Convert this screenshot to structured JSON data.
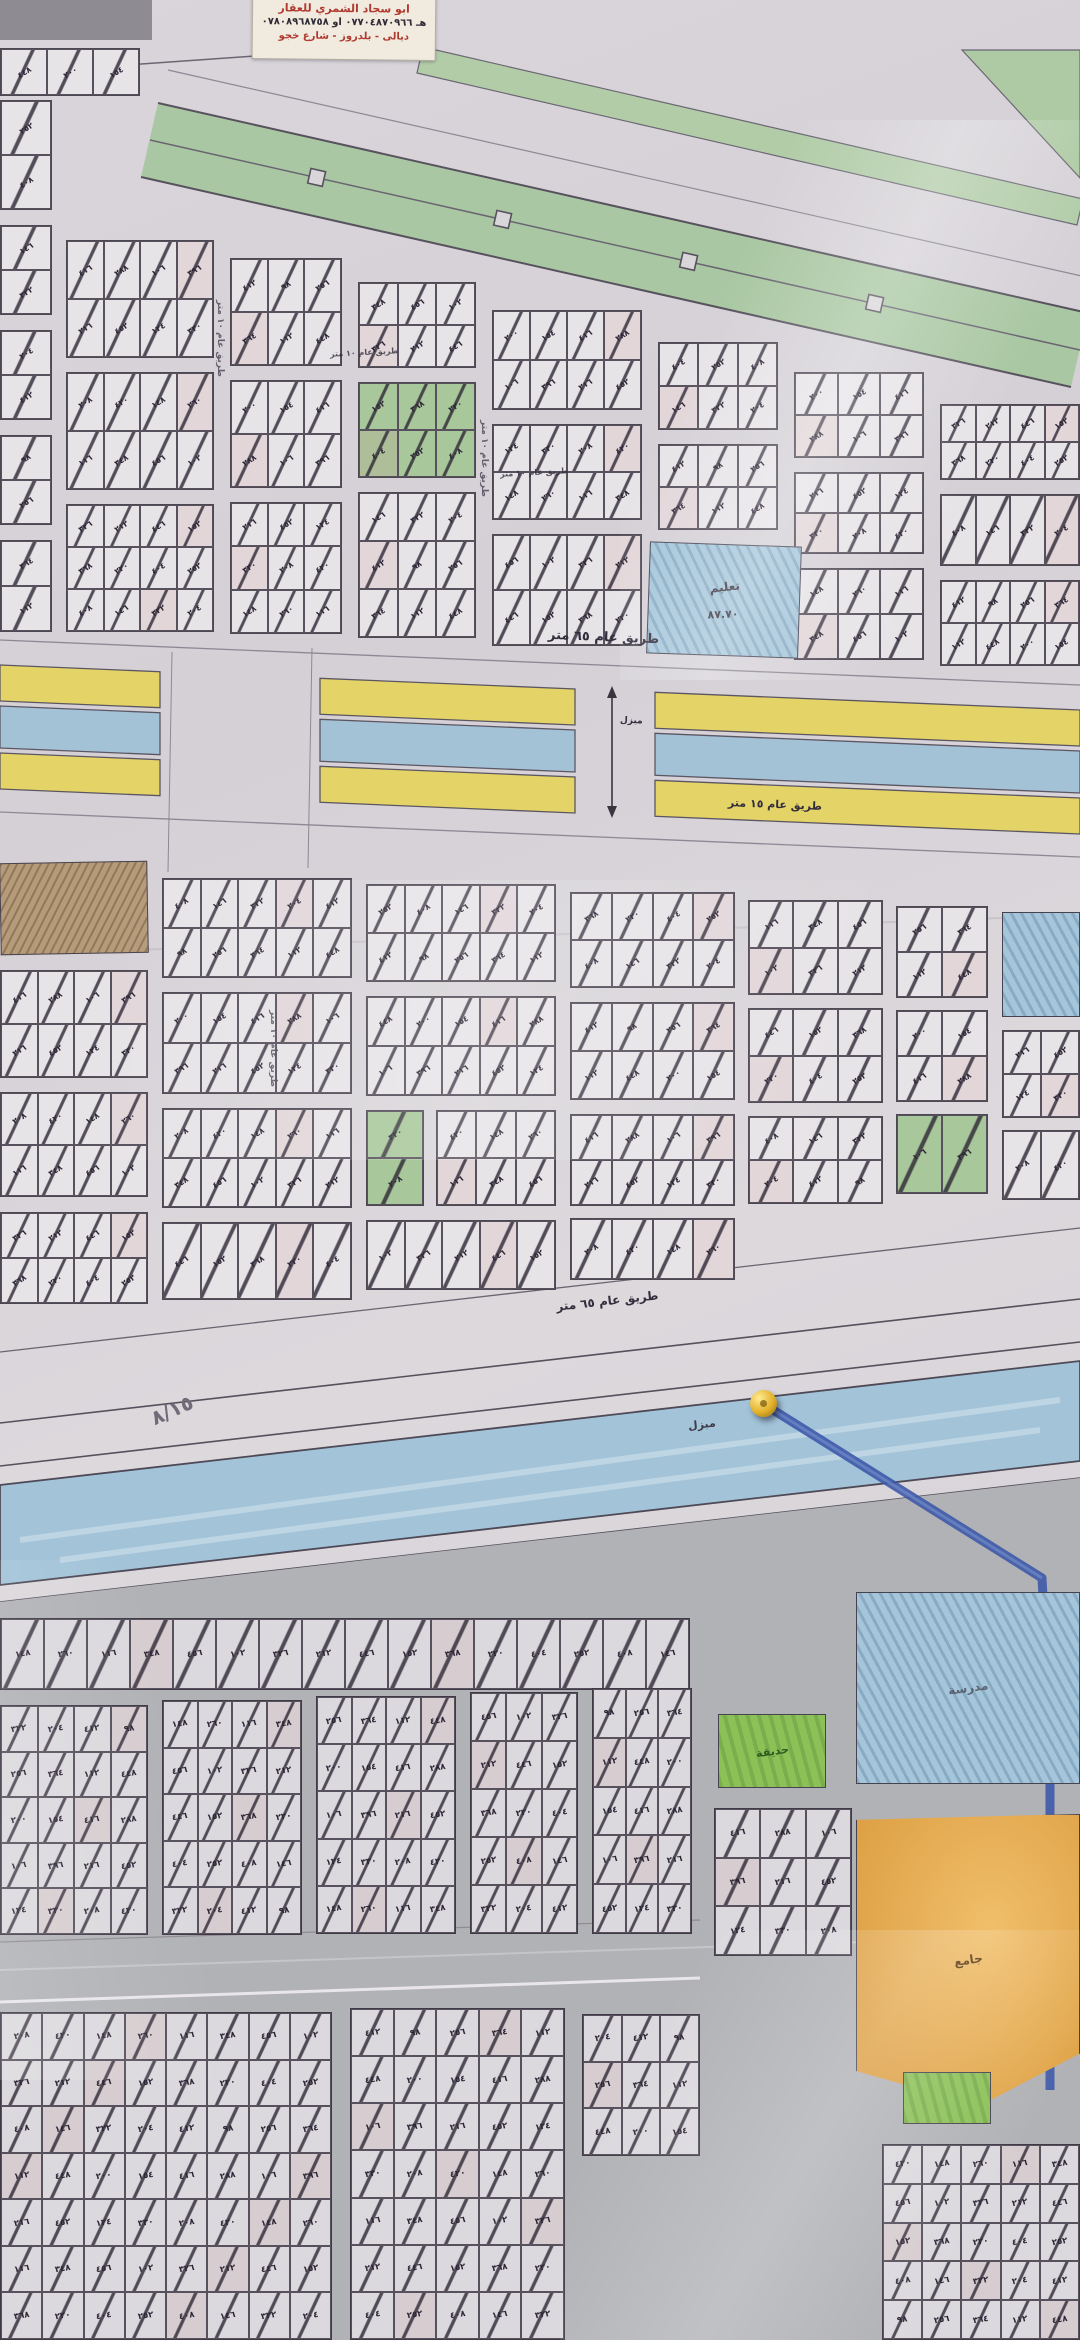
{
  "sticker": {
    "line1": "مكتب",
    "line2": "ابو سجاد الشمري للعقار",
    "line3": "هـ ٠٧٧٠٤٨٧٠٩٦٦ او ٠٧٨٠٨٩٦٨٧٥٨",
    "line4": "ديالى - بلدروز - شارع خجو"
  },
  "labels": {
    "road_65m": "طريق عام ٦٥ متر",
    "road_15m": "طريق عام ١٥ متر",
    "road_10m": "طريق عام ١٠ متر",
    "canal": "مبزل",
    "dimension": "٨٧.٧٠",
    "pencil_note": "٨/١٥",
    "zone_education": "تعليم",
    "zone_garden": "حديقة",
    "zone_school": "مدرسة",
    "zone_mosque": "جامع"
  },
  "plots": {
    "number_pool": [
      "٢٥٢",
      "٤٠٨",
      "١٤٦",
      "٣٢٢",
      "٢٠٤",
      "٤١٢",
      "٩٨",
      "٢٥٦",
      "٣٦٤",
      "١١٢",
      "٤٤٨",
      "٢٠٠",
      "١٥٤",
      "٤١٦",
      "٢٨٨",
      "١٠٦",
      "٣٩٦",
      "٢١٦",
      "٤٥٢",
      "١٢٤",
      "٣٣٠",
      "٢٠٨",
      "٤٢٠",
      "١٤٨",
      "٢٦٠",
      "١١٦",
      "٣٤٨",
      "٤٥٦",
      "١٠٢",
      "٣٢٦",
      "٢١٢",
      "٤٤٦",
      "١٥٢",
      "٣٦٨",
      "٢٢٠",
      "٤٠٤"
    ]
  },
  "colors": {
    "paper": "#d7d3d8",
    "boulevard_green": "#a9c7a2",
    "road_yellow": "#e4d468",
    "canal_blue": "#a2c3d8",
    "zone_orange": "#e9a948",
    "zone_green": "#8cc158",
    "pin_gold": "#e3b02a",
    "pen_blue": "#3b57a9",
    "sticker_red": "#b03a30",
    "ink": "#2c2535"
  }
}
